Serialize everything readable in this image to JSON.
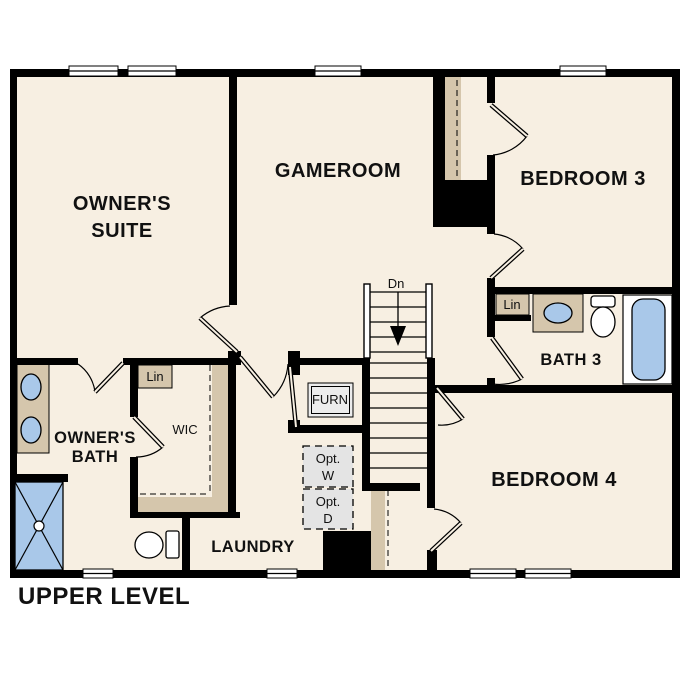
{
  "page_title": "UPPER LEVEL",
  "colors": {
    "floor": "#f7efe2",
    "wall": "#000000",
    "casework": "#d5c6ac",
    "fixture_blue": "#a9c8e9",
    "optional_fill": "#e4e4e4",
    "furnace_fill": "#ececec",
    "background": "#ffffff"
  },
  "rooms": {
    "owners_suite": {
      "line1": "OWNER'S",
      "line2": "SUITE"
    },
    "gameroom": {
      "label": "GAMEROOM"
    },
    "bedroom3": {
      "label": "BEDROOM 3"
    },
    "bath3": {
      "label": "BATH 3"
    },
    "bedroom4": {
      "label": "BEDROOM 4"
    },
    "owners_bath": {
      "line1": "OWNER'S",
      "line2": "BATH"
    },
    "wic": {
      "label": "WIC"
    },
    "laundry": {
      "label": "LAUNDRY"
    }
  },
  "features": {
    "linen_wic": "Lin",
    "linen_bath3": "Lin",
    "furnace": "FURN",
    "optional_washer": {
      "line1": "Opt.",
      "line2": "W"
    },
    "optional_dryer": {
      "line1": "Opt.",
      "line2": "D"
    },
    "stairs_direction": "Dn"
  }
}
